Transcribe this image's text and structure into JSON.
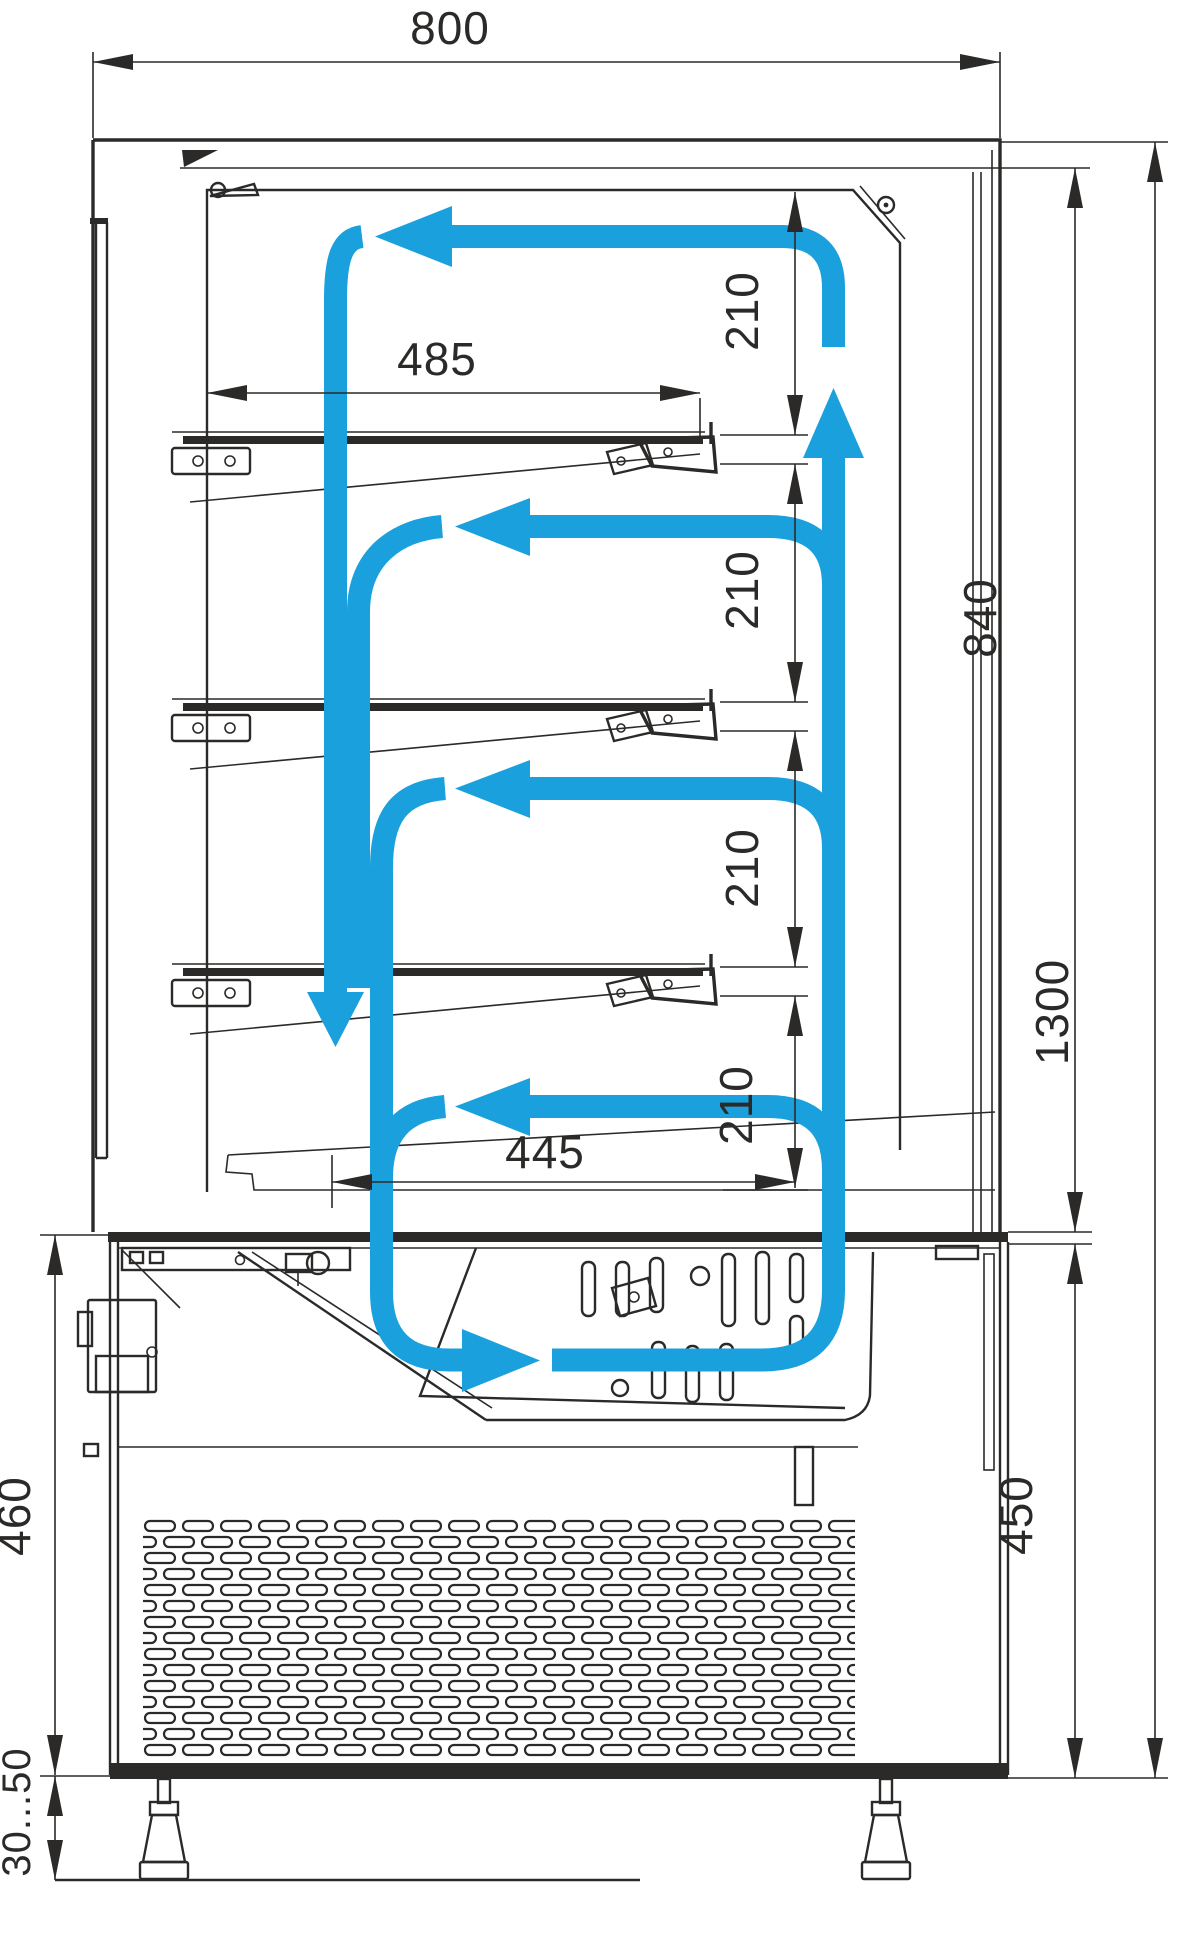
{
  "drawing": {
    "type": "refrigerated patisserie display case - side section with airflow",
    "line_color": "#2B2A29",
    "airflow_color": "#1AA0DC",
    "dimensions": {
      "overall_width": "800",
      "shelf_depth": "485",
      "bottom_shelf_depth": "445",
      "shelf_gap": "210",
      "display_section_height": "840",
      "overall_height": "1300",
      "base_section_height": "450",
      "machine_compartment_height": "460",
      "foot_adjust_range": "30...50"
    }
  }
}
